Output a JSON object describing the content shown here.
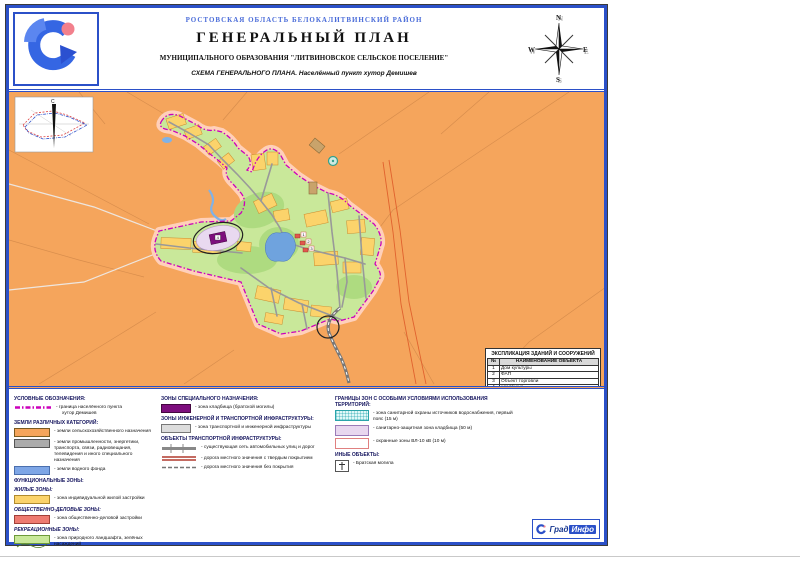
{
  "document": {
    "region_line": "РОСТОВСКАЯ ОБЛАСТЬ БЕЛОКАЛИТВИНСКИЙ РАЙОН",
    "title": "ГЕНЕРАЛЬНЫЙ ПЛАН",
    "subtitle": "МУНИЦИПАЛЬНОГО ОБРАЗОВАНИЯ \"ЛИТВИНОВСКОЕ СЕЛЬСКОЕ  ПОСЕЛЕНИЕ\"",
    "scheme_line": "СХЕМА ГЕНЕРАЛЬНОГО ПЛАНА. Населённый пункт хутор Демишев"
  },
  "compass": {
    "n": "N",
    "e": "E",
    "s": "S",
    "w": "W"
  },
  "map": {
    "inset_north_label": "С",
    "markers": [
      "1",
      "2",
      "3",
      "4"
    ]
  },
  "explication": {
    "title": "ЭКСПЛИКАЦИЯ ЗДАНИЙ И СООРУЖЕНИЙ",
    "col_num": "№",
    "col_name": "НАИМЕНОВАНИЕ ОБЪЕКТА",
    "rows": [
      {
        "num": "1",
        "name": "Дом культуры"
      },
      {
        "num": "2",
        "name": "ФАП"
      },
      {
        "num": "3",
        "name": "Объект торговли"
      },
      {
        "num": "4",
        "name": "кладбище"
      }
    ]
  },
  "legend": {
    "col1": {
      "title": "УСЛОВНЫЕ ОБОЗНАЧЕНИЯ:",
      "boundary_label_1": "- граница населённого пункта",
      "boundary_label_2": "хутор Демишев",
      "categories_header": "ЗЕМЛИ РАЗЛИЧНЫХ КАТЕГОРИЙ:",
      "agri": "- земли сельскохозяйственного назначения",
      "industry": "- земли промышленности, энергетики, транспорта, связи, радиовещания, телевидения и иного специального назначения",
      "water": "- земли водного фонда",
      "functional_header": "ФУНКЦИОНАЛЬНЫЕ ЗОНЫ:",
      "residential_header": "ЖИЛЫЕ ЗОНЫ:",
      "residential": "- зона индивидуальной жилой застройки",
      "business_header": "ОБЩЕСТВЕННО-ДЕЛОВЫЕ ЗОНЫ:",
      "business": "- зона общественно-деловой застройки",
      "recreation_header": "РЕКРЕАЦИОННЫЕ ЗОНЫ:",
      "recreation": "- зона природного ландшафта, зелёных насаждений"
    },
    "col2": {
      "special_header": "ЗОНЫ СПЕЦИАЛЬНОГО НАЗНАЧЕНИЯ:",
      "cemetery": "- зона кладбища (братской могилы)",
      "infra_header": "ЗОНЫ ИНЖЕНЕРНОЙ И ТРАНСПОРТНОЙ ИНФРАСТРУКТУРЫ:",
      "transport_zone": "- зона транспортной и инженерной инфраструктуры",
      "transport_objects_header": "ОБЪЕКТЫ ТРАНСПОРТНОЙ ИНФРАСТРУКТУРЫ:",
      "street_network": "- существующая сеть автомобильных улиц и дорог",
      "paved_road": "- дорога местного значения с твердым покрытием",
      "unpaved_road": "- дорога местного значения без покрытия"
    },
    "col3": {
      "zones_header": "ГРАНИЦЫ ЗОН С ОСОБЫМИ УСЛОВИЯМИ ИСПОЛЬЗОВАНИЯ ТЕРРИТОРИЙ:",
      "water_protection": "- зона санитарной охраны источников водоснабжения, первый пояс (15 м)",
      "cemetery_buffer": "- санитарно-защитная зона кладбища (50 м)",
      "power_line": "- охранные зоны ВЛ-10 кВ (10 м)",
      "other_header": "ИНЫЕ ОБЪЕКТЫ:",
      "war_grave": "- Братская могила"
    }
  },
  "footer": {
    "brand_first": "Град",
    "brand_second": "Инфо"
  },
  "colors": {
    "sheet_border": "#2b50c8",
    "agricultural_land": "#f5a55c",
    "settlement_green": "#c9e89a",
    "residential_yellow": "#fbd36b",
    "water_blue": "#6fa3de",
    "boundary_magenta": "#cc00bb",
    "boundary_halo": "#ffd0ba",
    "cemetery_purple": "#7d0e7d",
    "cemetery_buffer": "#e9d9f0",
    "business_red": "#ee7a70",
    "road_gray": "#999999",
    "header_blue_text": "#4a6cd9"
  }
}
